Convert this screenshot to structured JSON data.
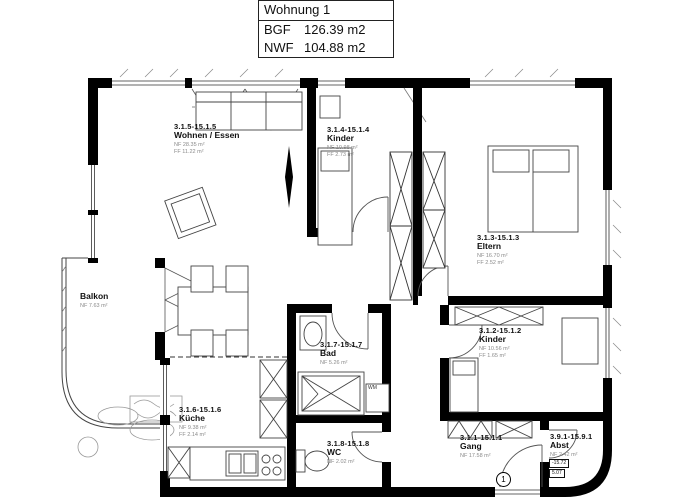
{
  "title_block": {
    "title": "Wohnung 1",
    "bgf_label": "BGF",
    "bgf_value": "126.39 m2",
    "nwf_label": "NWF",
    "nwf_value": "104.88 m2"
  },
  "rooms": {
    "wohnen": {
      "id": "3.1.5-15.1.5",
      "name": "Wohnen / Essen",
      "nf": "NF 28.35 m²",
      "ff": "FF 11.22 m²"
    },
    "kinder1": {
      "id": "3.1.4-15.1.4",
      "name": "Kinder",
      "nf": "NF 10.98 m²",
      "ff": "FF 2.73 m²"
    },
    "eltern": {
      "id": "3.1.3-15.1.3",
      "name": "Eltern",
      "nf": "NF 16.70 m²",
      "ff": "FF 2.52 m²"
    },
    "kinder2": {
      "id": "3.1.2-15.1.2",
      "name": "Kinder",
      "nf": "NF 10.56 m²",
      "ff": "FF 1.65 m²"
    },
    "kueche": {
      "id": "3.1.6-15.1.6",
      "name": "Küche",
      "nf": "NF 9.38 m²",
      "ff": "FF 2.14 m²"
    },
    "bad": {
      "id": "3.1.7-15.1.7",
      "name": "Bad",
      "nf": "NF 5.26 m²"
    },
    "wc": {
      "id": "3.1.8-15.1.8",
      "name": "WC",
      "nf": "NF 2.02 m²"
    },
    "gang": {
      "id": "3.1.1-15.1.1",
      "name": "Gang",
      "nf": "NF 17.58 m²"
    },
    "abst": {
      "id": "3.9.1-15.9.1",
      "name": "Abst",
      "nf": "NF 2.42 m²"
    },
    "balkon": {
      "name": "Balkon",
      "nf": "NF 7.63 m²"
    }
  },
  "annotations": {
    "wm": "WM",
    "entrance_door_number": "1",
    "level_upper": "-15.72",
    "level_lower": "5.07"
  },
  "colors": {
    "wall": "#000000",
    "thin_line": "#3a3a3a",
    "area_text": "#8b8b8b",
    "background": "#ffffff"
  }
}
